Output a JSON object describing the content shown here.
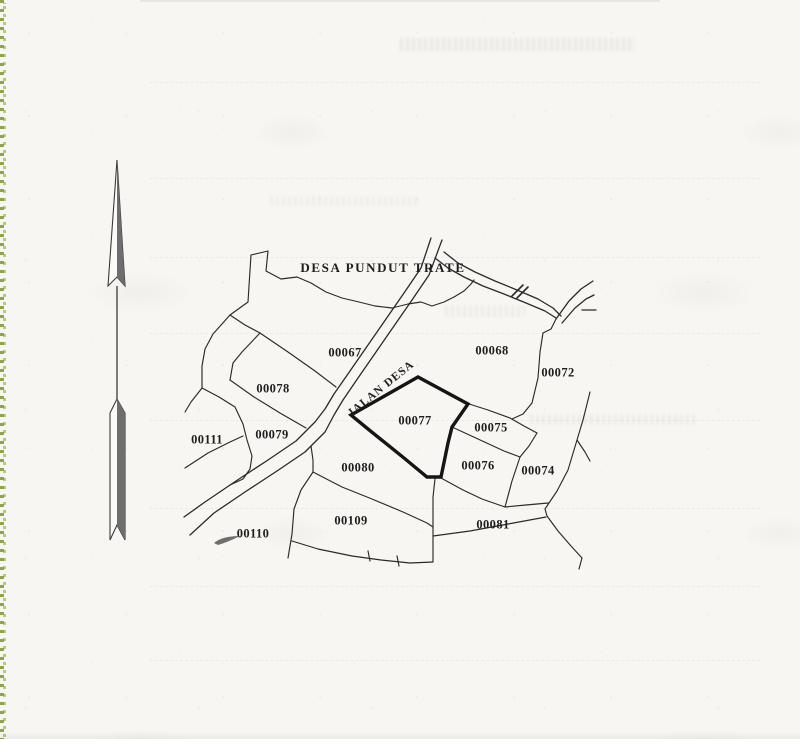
{
  "page": {
    "kind": "scanned cadastral sketch map",
    "orientation_note": "north arrow at left"
  },
  "map": {
    "village_label": "DESA PUNDUT TRATE",
    "road_label": "JALAN DESA",
    "highlighted_parcel": "00077",
    "parcels": [
      {
        "label": "00067",
        "highlighted": false
      },
      {
        "label": "00068",
        "highlighted": false
      },
      {
        "label": "00072",
        "highlighted": false
      },
      {
        "label": "00078",
        "highlighted": false
      },
      {
        "label": "00079",
        "highlighted": false
      },
      {
        "label": "00111",
        "highlighted": false
      },
      {
        "label": "00077",
        "highlighted": true
      },
      {
        "label": "00075",
        "highlighted": false
      },
      {
        "label": "00080",
        "highlighted": false
      },
      {
        "label": "00076",
        "highlighted": false
      },
      {
        "label": "00074",
        "highlighted": false
      },
      {
        "label": "00110",
        "highlighted": false
      },
      {
        "label": "00109",
        "highlighted": false
      },
      {
        "label": "00081",
        "highlighted": false
      }
    ]
  },
  "icons": {
    "north_arrow": "north-arrow",
    "pen_mark": "pen-smudge near parcel 00110"
  },
  "colors": {
    "paper": "#f7f6f2",
    "ink": "#262626",
    "bold_outline": "#151515",
    "edge_green": "#8aa23f",
    "arrow_shade": "#6e6e6e"
  }
}
